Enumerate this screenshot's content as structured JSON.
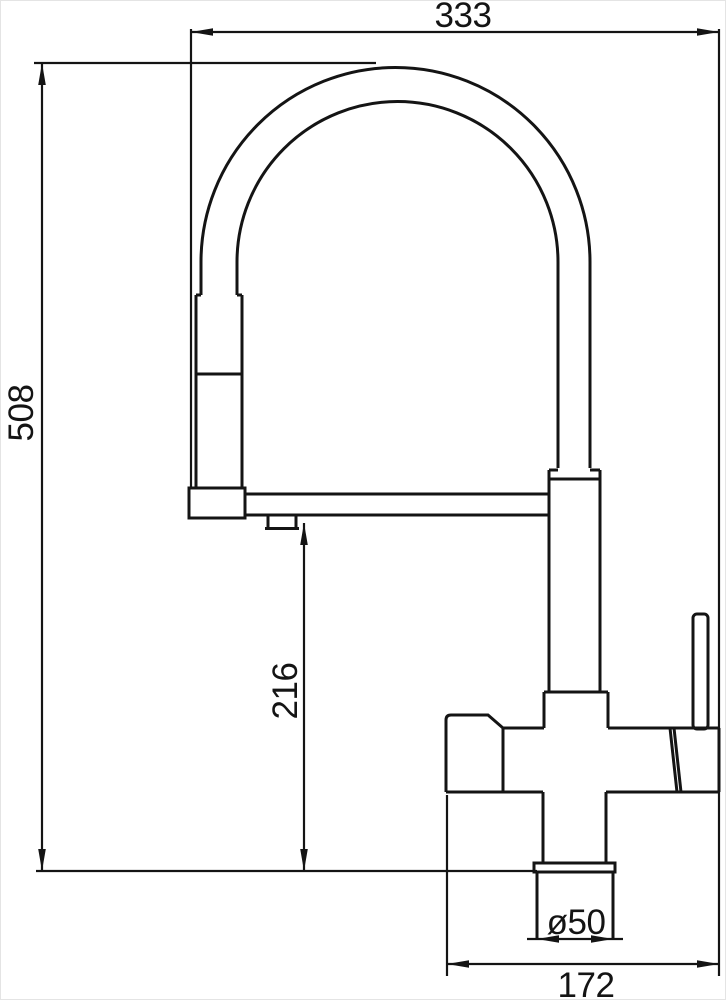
{
  "drawing": {
    "type": "technical-dimension-drawing",
    "subject": "kitchen mixer faucet with pull-down spring spout, side elevation",
    "units": "mm",
    "line_color": "#141414",
    "background_color": "#ffffff",
    "dimensions": {
      "overall_width": {
        "label": "333",
        "orientation": "horizontal",
        "position": "top"
      },
      "overall_height": {
        "label": "508",
        "orientation": "vertical",
        "position": "left"
      },
      "spout_height": {
        "label": "216",
        "orientation": "vertical",
        "position": "middle"
      },
      "base_diameter": {
        "label": "ø50",
        "orientation": "horizontal",
        "position": "base"
      },
      "body_width": {
        "label": "172",
        "orientation": "horizontal",
        "position": "bottom"
      }
    }
  }
}
